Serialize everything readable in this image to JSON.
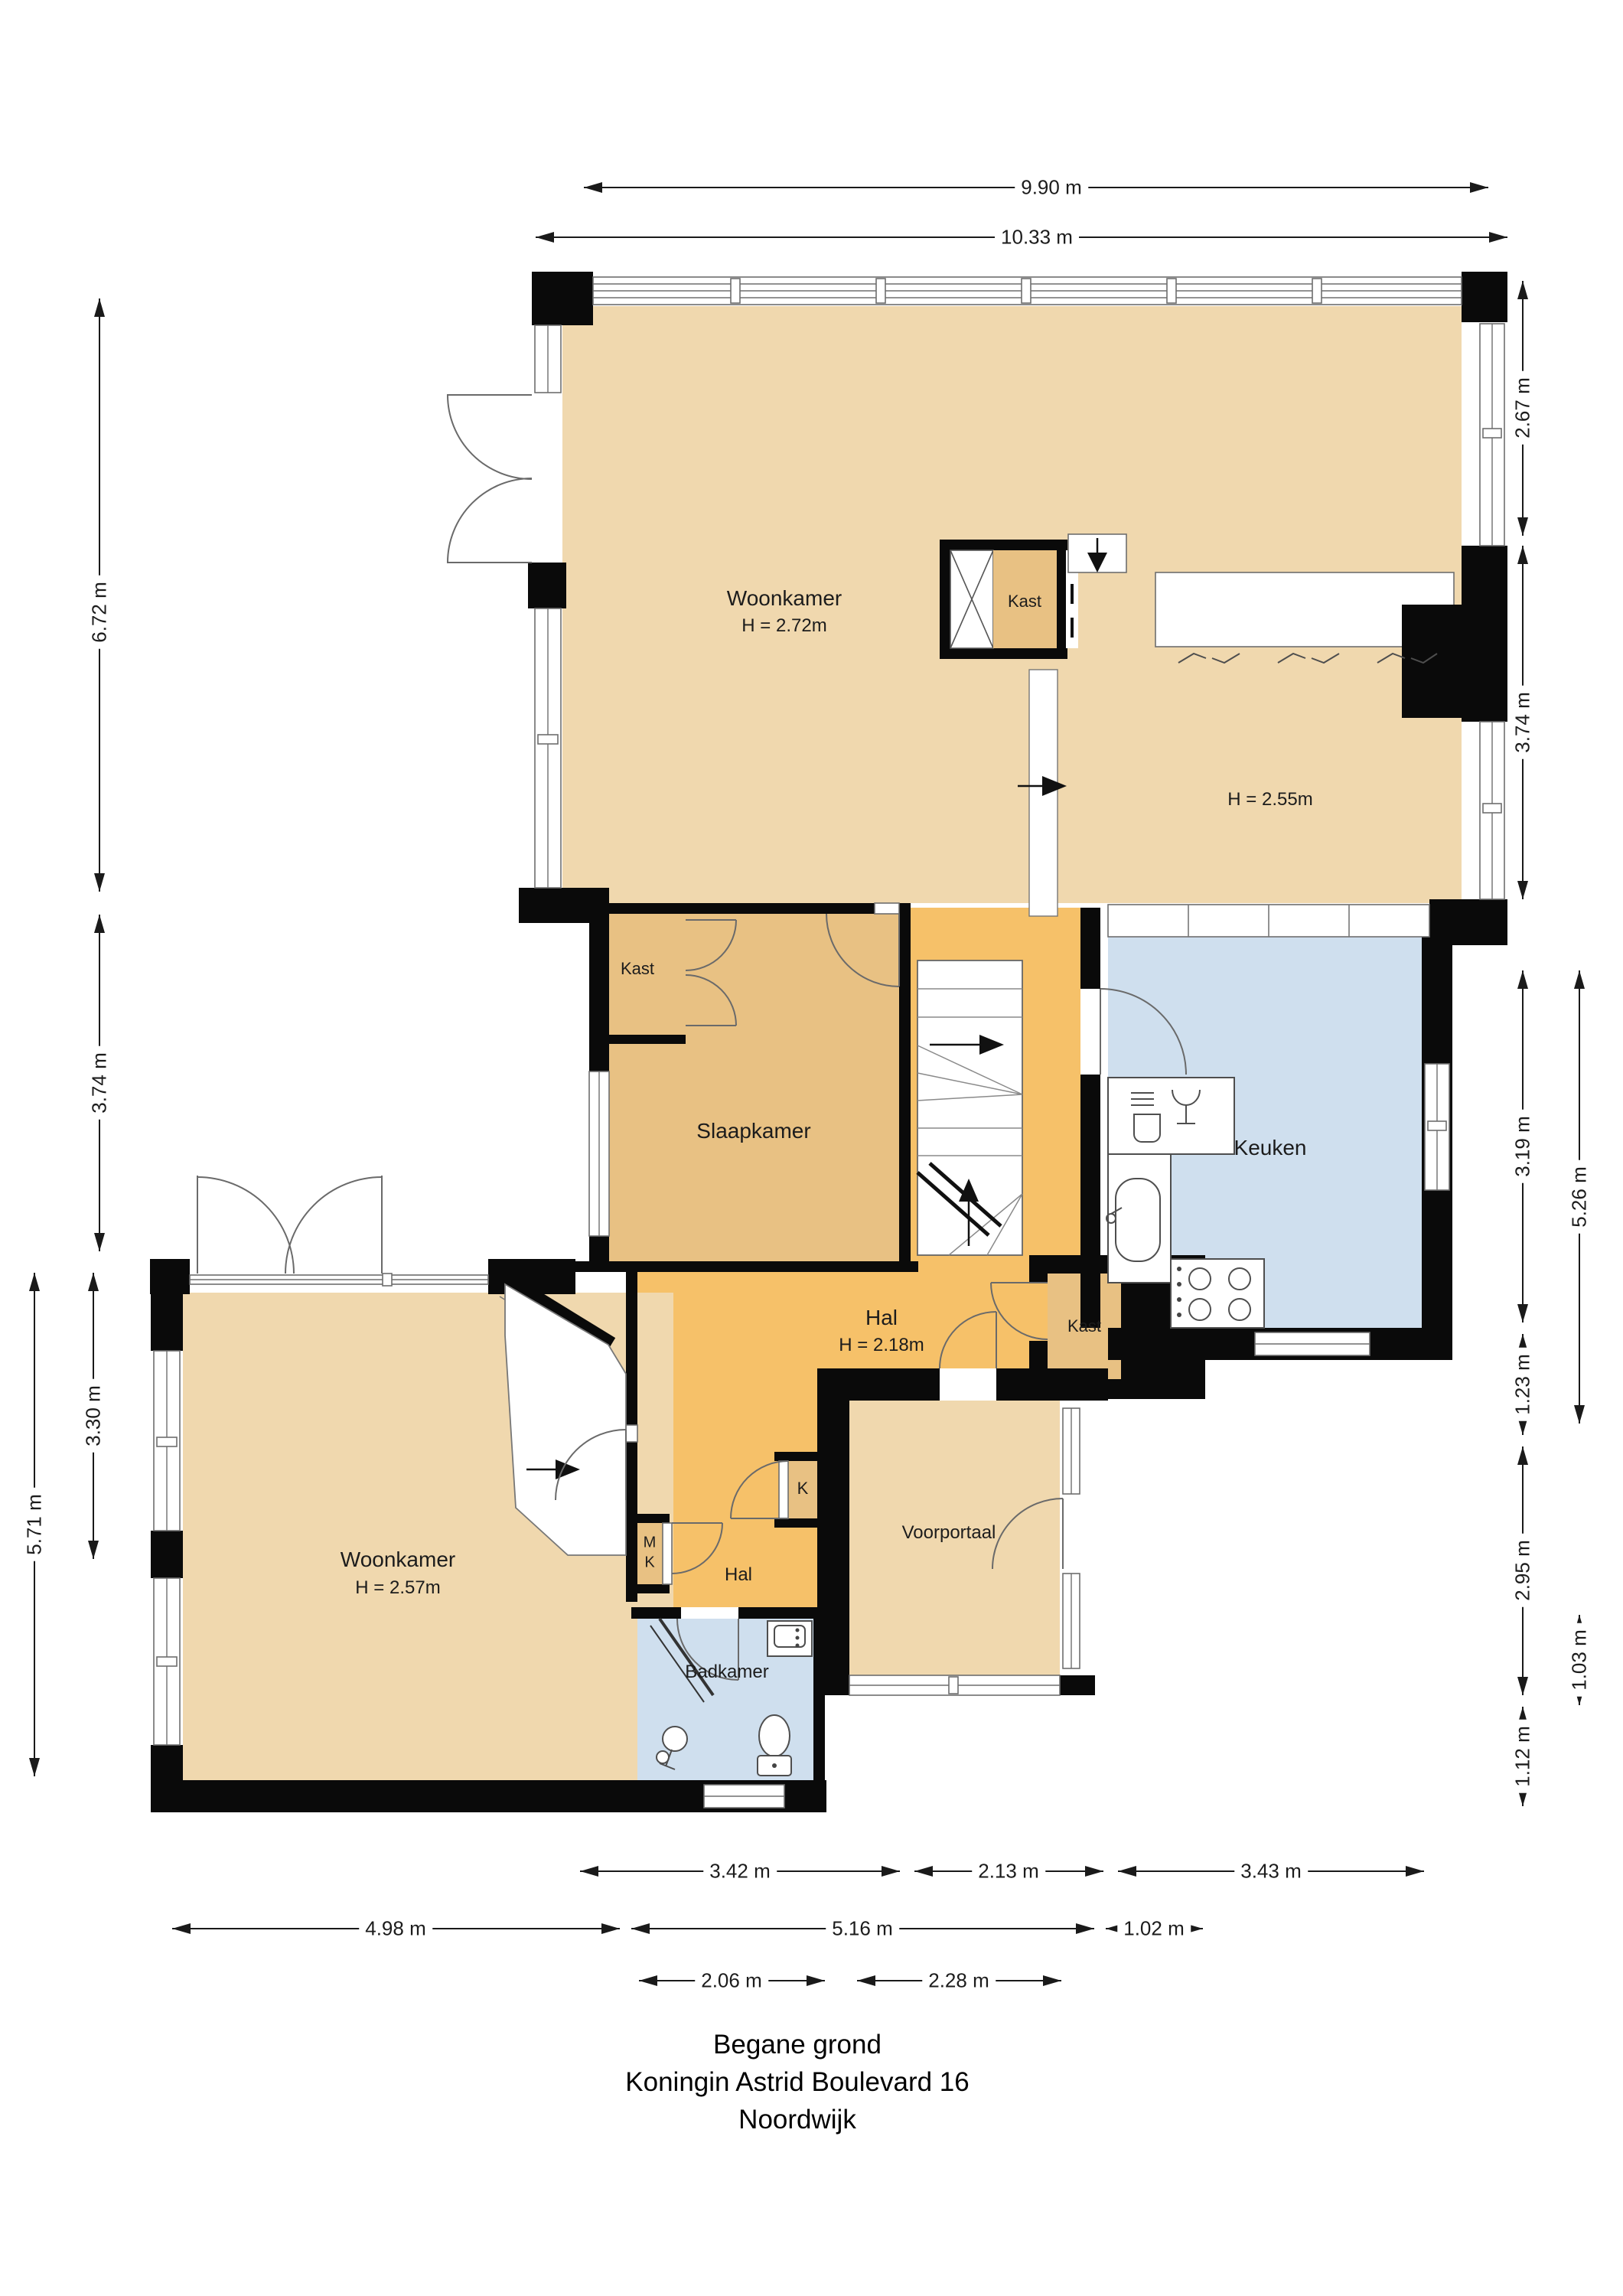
{
  "title": {
    "line1": "Begane grond",
    "line2": "Koningin Astrid Boulevard 16",
    "line3": "Noordwijk"
  },
  "rooms": {
    "woonkamer_top": {
      "name": "Woonkamer",
      "height": "H = 2.72m"
    },
    "room_h255": {
      "height": "H = 2.55m"
    },
    "kast_box": {
      "name": "Kast"
    },
    "kast_top": {
      "name": "Kast"
    },
    "slaapkamer": {
      "name": "Slaapkamer"
    },
    "keuken": {
      "name": "Keuken"
    },
    "hal": {
      "name": "Hal",
      "height": "H = 2.18m"
    },
    "kast_hal": {
      "name": "Kast"
    },
    "woonkamer_bottom": {
      "name": "Woonkamer",
      "height": "H = 2.57m"
    },
    "voorportaal": {
      "name": "Voorportaal"
    },
    "hal_small": {
      "name": "Hal"
    },
    "badkamer": {
      "name": "Badkamer"
    },
    "k_closet": {
      "name": "K"
    },
    "mk_closet": {
      "line1": "M",
      "line2": "K"
    }
  },
  "dimensions": {
    "top": [
      {
        "label": "9.90 m"
      },
      {
        "label": "10.33 m"
      }
    ],
    "left": [
      {
        "label": "6.72 m"
      },
      {
        "label": "3.74 m"
      },
      {
        "label": "3.30 m"
      },
      {
        "label": "5.71 m"
      }
    ],
    "right": [
      {
        "label": "2.67 m"
      },
      {
        "label": "3.74 m"
      },
      {
        "label": "3.19 m"
      },
      {
        "label": "1.23 m"
      },
      {
        "label": "2.95 m"
      },
      {
        "label": "1.12 m"
      },
      {
        "label": "5.26 m"
      },
      {
        "label": "1.03 m"
      }
    ],
    "bottom": [
      {
        "label": "3.42 m"
      },
      {
        "label": "2.13 m"
      },
      {
        "label": "3.43 m"
      },
      {
        "label": "4.98 m"
      },
      {
        "label": "5.16 m"
      },
      {
        "label": "1.02 m"
      },
      {
        "label": "2.06 m"
      },
      {
        "label": "2.28 m"
      }
    ]
  },
  "colors": {
    "wall": "#0a0a0a",
    "tan": "#f0d8ae",
    "gold": "#e8c183",
    "orange": "#f6c169",
    "blue": "#cfdfee",
    "dim": "#1a1a1a"
  }
}
